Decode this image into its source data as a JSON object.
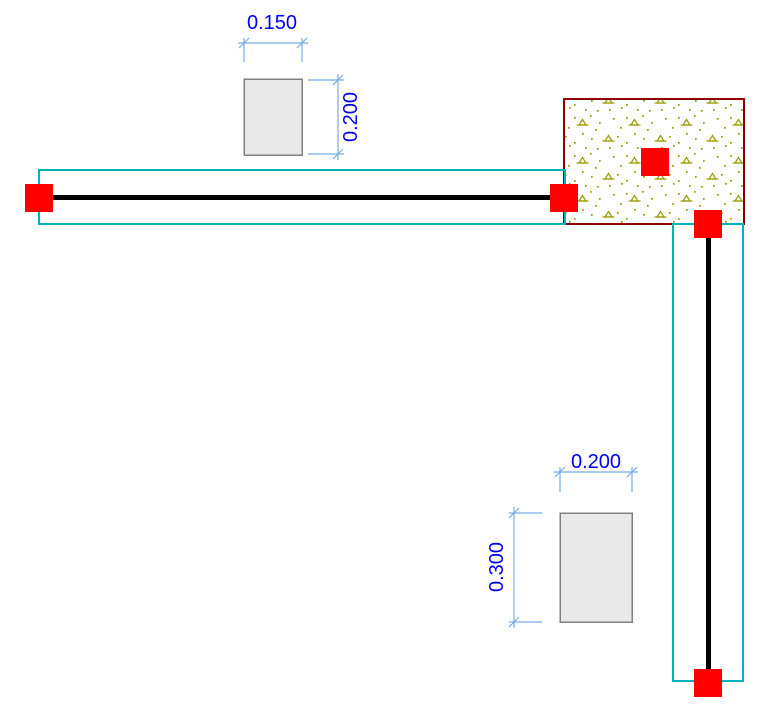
{
  "app": {
    "name": "structural-model-drawing",
    "view": "plan-view-frame-model"
  },
  "colors": {
    "background": "#ffffff",
    "member_extent_outline": "#00b2bc",
    "frame_member_line": "#000000",
    "joint_node": "#fe0000",
    "wall_panel_border": "#8e0000",
    "concrete_hatch": "#9a9a00",
    "section_fill": "#e9e9e9",
    "section_border": "#808080",
    "dimension_line": "#78ace6",
    "dimension_text": "#0000f0"
  },
  "sections": {
    "top": {
      "width_label": "0.150",
      "height_label": "0.200"
    },
    "bottom": {
      "width_label": "0.200",
      "height_label": "0.300"
    }
  },
  "model": {
    "joint_count": 5,
    "frame_members": [
      "horizontal-beam",
      "vertical-beam"
    ],
    "wall_panel_hatch": "concrete"
  }
}
